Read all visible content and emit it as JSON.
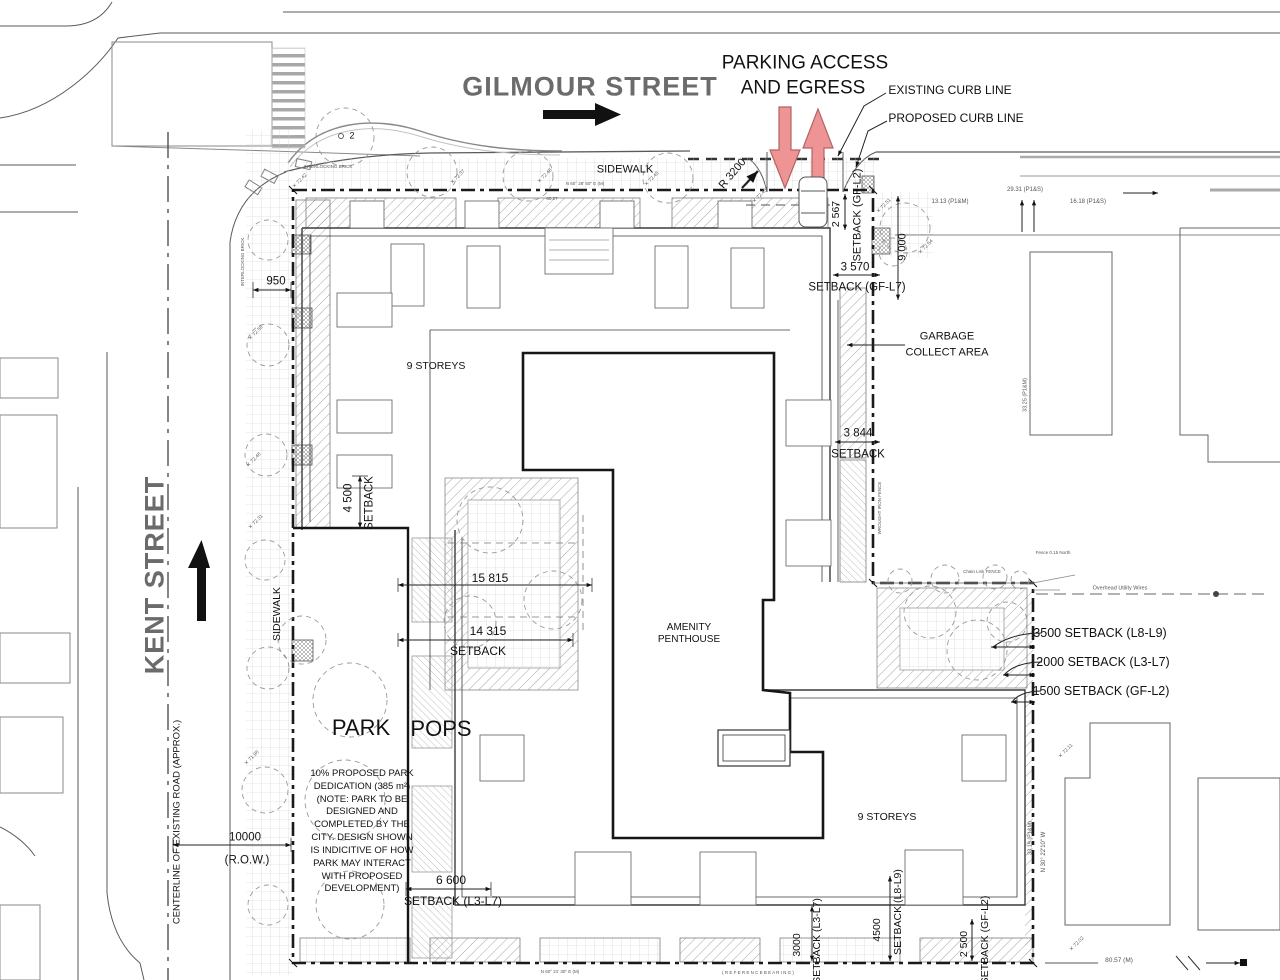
{
  "labels": {
    "gilmour": "GILMOUR STREET",
    "kent": "KENT STREET",
    "centerline": "CENTERLINE OF EXISTING ROAD (APPROX.)",
    "sidewalk_top": "SIDEWALK",
    "sidewalk_left": "SIDEWALK",
    "parking1": "PARKING ACCESS",
    "parking2": "AND EGRESS",
    "existing_curb": "EXISTING CURB LINE",
    "proposed_curb": "PROPOSED CURB LINE",
    "r3200": "R 3200",
    "storeys_nw": "9 STOREYS",
    "storeys_se": "9 STOREYS",
    "amenity1": "AMENITY",
    "amenity2": "PENTHOUSE",
    "garbage1": "GARBAGE",
    "garbage2": "COLLECT AREA",
    "park": "PARK",
    "pops": "POPS",
    "tree2": "2",
    "d950": "950",
    "d4500w": "4 500",
    "sb_w": "SETBACK",
    "d15815": "15 815",
    "d14315": "14 315",
    "sb_mid": "SETBACK",
    "d6600": "6 600",
    "sb_sw": "SETBACK (L3-L7)",
    "d10000": "10000",
    "row": "(R.O.W.)",
    "d2567": "2 567",
    "sb_ne_gfl2": "SETBACK (GF-L2)",
    "d9000": "9 000",
    "d3570": "3 570",
    "sb_gfl7": "SETBACK (GF-L7)",
    "d3844": "3 844",
    "sb_ne2": "SETBACK",
    "sb3500": "3500 SETBACK (L8-L9)",
    "sb2000": "2000 SETBACK (L3-L7)",
    "sb1500": "1500 SETBACK (GF-L2)",
    "d3000b": "3000",
    "sb_b1": "SETBACK (L3-L7)",
    "d4500b": "4500",
    "sb_b2": "SETBACK (L8-L9)",
    "d2500b": "2 500",
    "sb_b3": "SETBACK (GF-L2)"
  },
  "survey": {
    "s1313": "13.13 (P1&M)",
    "s2931": "29.31 (P1&S)",
    "s1618": "16.18 (P1&S)",
    "s3325": "33.25 (P1&M)",
    "s3319": "33.19 (P1&M)",
    "bearing_e": "N 30° 22'10\" W",
    "d8057": "80.57 (M)",
    "wires": "Overhead Utility Wires",
    "bearing_top": "N 60° 28' 50\" E  (M)",
    "b6027": "60.27",
    "chainlink": "Chain Link FENCE",
    "fence015": "Fence 0.15 North",
    "wrought": "WROUGHT IRON FENCE",
    "brick1": "INTERLOCKING BRICK",
    "brick2": "INTERLOCKING BRICK",
    "refbearing": "( R E F E R E N C E   B E A R I N G )",
    "bearing_bot": "N 60° 21' 30\" E  (M)"
  },
  "park_note": [
    "10% PROPOSED PARK",
    "DEDICATION (385 m²)",
    "(NOTE: PARK TO BE",
    "DESIGNED AND",
    "COMPLETED BY THE",
    "CITY. DESIGN SHOWN",
    "IS INDICITIVE OF HOW",
    "PARK MAY INTERACT",
    "WITH PROPOSED",
    "DEVELOPMENT)"
  ],
  "elevations": [
    {
      "x": 300,
      "y": 181,
      "v": "72.42"
    },
    {
      "x": 458,
      "y": 177,
      "v": "72.37"
    },
    {
      "x": 652,
      "y": 179,
      "v": "72.45"
    },
    {
      "x": 545,
      "y": 176,
      "v": "72.48"
    },
    {
      "x": 884,
      "y": 206,
      "v": "72.51"
    },
    {
      "x": 926,
      "y": 247,
      "v": "72.54"
    },
    {
      "x": 256,
      "y": 333,
      "v": "72.58"
    },
    {
      "x": 254,
      "y": 460,
      "v": "72.48"
    },
    {
      "x": 256,
      "y": 522,
      "v": "72.31"
    },
    {
      "x": 252,
      "y": 758,
      "v": "71.98"
    },
    {
      "x": 1066,
      "y": 751,
      "v": "72.11"
    },
    {
      "x": 1077,
      "y": 944,
      "v": "72.02"
    },
    {
      "x": 760,
      "y": 196,
      "v": "72.45"
    }
  ],
  "colors": {
    "arrow_red_fill": "#ef9494",
    "arrow_red_stroke": "#b06363",
    "street_gray": "#6b6b6b",
    "line_dark": "#1a1a1a"
  }
}
